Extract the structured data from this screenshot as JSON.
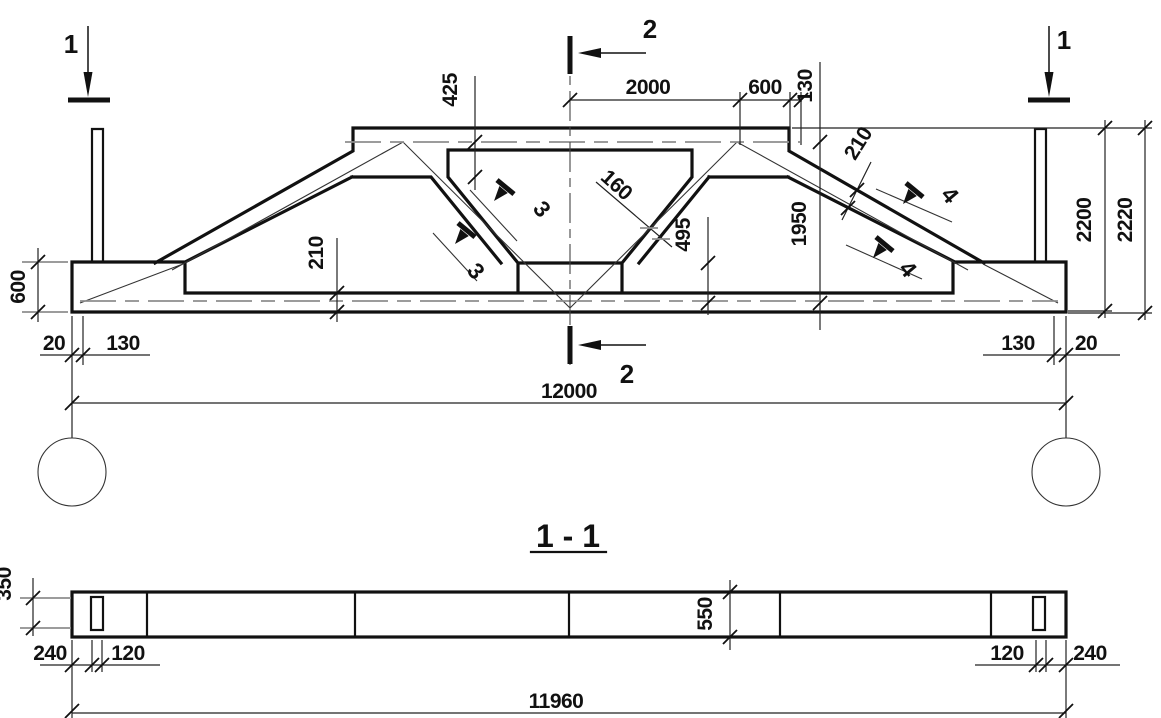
{
  "title": "1 - 1",
  "colors": {
    "line": "#111111",
    "gray": "#8f8f8f",
    "background": "#ffffff"
  },
  "section_markers": {
    "left": "1",
    "right": "1",
    "top": "2",
    "bottom": "2"
  },
  "detail_markers": {
    "web_upper": "3",
    "web_lower": "3",
    "chord_upper": "4",
    "chord_lower": "4"
  },
  "elevation": {
    "dims": {
      "deck_thickness": "425",
      "half_deck": "2000",
      "deck_end": "600",
      "deck_overhang": "130",
      "web_width": "160",
      "web_height": "495",
      "chord_slope_thickness": "210",
      "mid_height": "1950",
      "bottom_chord_thickness": "210",
      "end_block_height": "600",
      "left_gap": "20",
      "left_edge": "130",
      "right_edge": "130",
      "right_gap": "20",
      "span": "12000",
      "height_inner": "2200",
      "height_overall": "2220"
    }
  },
  "plan": {
    "dims": {
      "end_width": "350",
      "left_offset": "240",
      "left_dowel": "120",
      "beam_width": "550",
      "right_dowel": "120",
      "right_offset": "240",
      "length": "11960"
    }
  }
}
